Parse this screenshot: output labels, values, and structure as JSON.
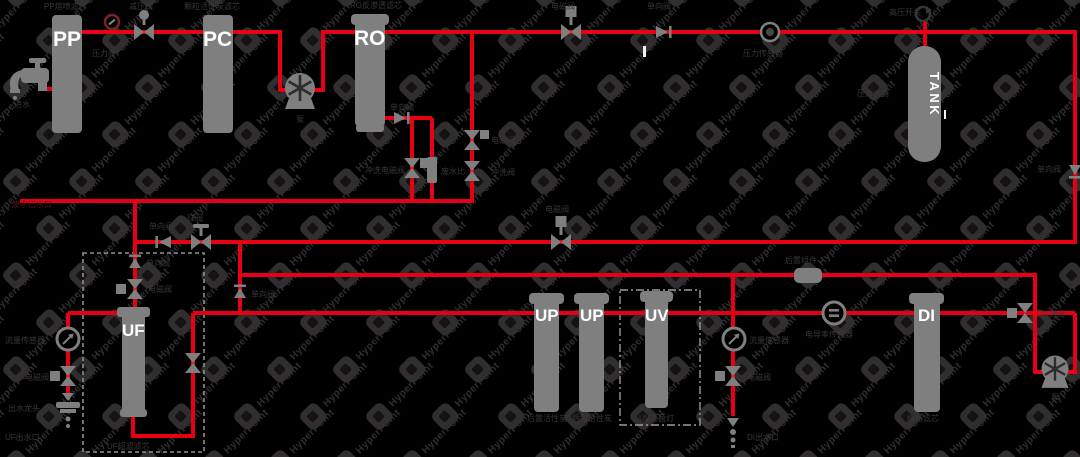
{
  "watermark": {
    "text": "HyperPoint"
  },
  "colors": {
    "background": "#000000",
    "pipe": "#e60012",
    "component": "#7f7f7f",
    "label": "#3a3637",
    "label_accent": "#5d1214",
    "column_text": "#ffffff",
    "check_valve_red": "#8b1a1a"
  },
  "columns": [
    {
      "label": "PP",
      "caption": "PP熔喷滤芯"
    },
    {
      "label": "PC",
      "caption": "颗粒活性炭滤芯"
    },
    {
      "label": "RO",
      "caption": "RO反渗透滤芯"
    },
    {
      "label": "TANK",
      "caption": "压力水桶"
    },
    {
      "label": "UF",
      "caption": "UF超滤滤芯"
    },
    {
      "label": "UP",
      "caption": "后置活性炭"
    },
    {
      "label": "UP",
      "caption": "后置活性炭"
    },
    {
      "label": "UV",
      "caption": "UV杀菌灯"
    },
    {
      "label": "DI",
      "caption": "树脂滤芯"
    }
  ],
  "labels": {
    "inlet": "进水",
    "pressure_gauge": "压力表",
    "reducing_valve": "减压阀",
    "pump1": "泵",
    "ro_check": "单向阀",
    "flush_solenoid": "冲洗电磁阀",
    "waste_ratio": "废水比",
    "solenoid_a": "电磁阀",
    "flush_valve": "冲洗阀",
    "waste_outlet": "废水出水口",
    "top_solenoid": "电磁阀",
    "top_check": "单向阀",
    "pressure_sensor": "压力传感器",
    "hp_switch": "高压开关",
    "right_check": "单向阀",
    "return_check": "单向阀",
    "ball_valve": "球阀",
    "return_solenoid": "电磁阀",
    "loop_check": "单向阀",
    "uf_check": "单向阀",
    "uf_solenoid": "电磁阀",
    "flow_sensor_left": "流量传感器",
    "left_solenoid": "电磁阀",
    "left_tap": "出水龙头",
    "uf_outlet": "UF出水口",
    "post_module": "后置组件",
    "flow_sensor_right": "流量传感器",
    "right_solenoid": "电磁阀",
    "di_outlet": "DI出水口",
    "tds_sensor": "电导率传感器",
    "three_way_valve": "三通阀",
    "pump2": "泵"
  }
}
